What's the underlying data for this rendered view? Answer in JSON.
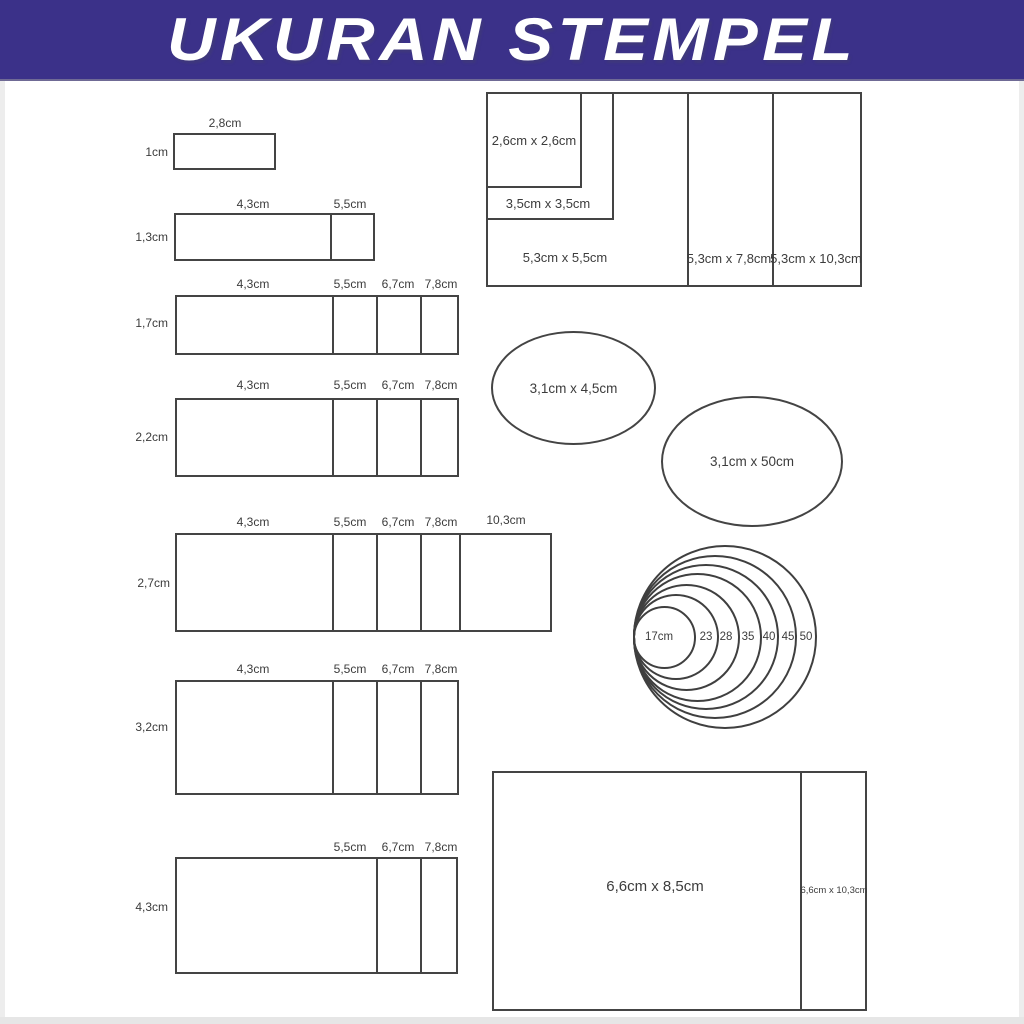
{
  "header": {
    "title": "UKURAN STEMPEL"
  },
  "colors": {
    "banner_bg": "#3b3189",
    "banner_text": "#ffffff",
    "line": "#444444",
    "label_text": "#3c3c3c",
    "frame": "#ededed"
  },
  "rows": [
    {
      "height_label": "1cm",
      "width_labels": [
        "2,8cm"
      ]
    },
    {
      "height_label": "1,3cm",
      "width_labels": [
        "4,3cm",
        "5,5cm"
      ]
    },
    {
      "height_label": "1,7cm",
      "width_labels": [
        "4,3cm",
        "5,5cm",
        "6,7cm",
        "7,8cm"
      ]
    },
    {
      "height_label": "2,2cm",
      "width_labels": [
        "4,3cm",
        "5,5cm",
        "6,7cm",
        "7,8cm"
      ]
    },
    {
      "height_label": "2,7cm",
      "width_labels": [
        "4,3cm",
        "5,5cm",
        "6,7cm",
        "7,8cm",
        "10,3cm"
      ]
    },
    {
      "height_label": "3,2cm",
      "width_labels": [
        "4,3cm",
        "5,5cm",
        "6,7cm",
        "7,8cm"
      ]
    },
    {
      "height_label": "4,3cm",
      "width_labels": [
        "5,5cm",
        "6,7cm",
        "7,8cm"
      ]
    }
  ],
  "squares": {
    "sq_2_6": "2,6cm x 2,6cm",
    "sq_3_5": "3,5cm x 3,5cm",
    "sq_5_5": "5,3cm x 5,5cm",
    "panel_7_8": "5,3cm x 7,8cm",
    "panel_10_3": "5,3cm x 10,3cm"
  },
  "ellipses": [
    {
      "label": "3,1cm x 4,5cm"
    },
    {
      "label": "3,1cm x 50cm"
    }
  ],
  "circles": {
    "labels": [
      "17cm",
      "23",
      "28",
      "35",
      "40",
      "45",
      "50"
    ]
  },
  "bottom_rect": {
    "main_label": "6,6cm x 8,5cm",
    "side_label": "6,6cm x 10,3cm"
  }
}
